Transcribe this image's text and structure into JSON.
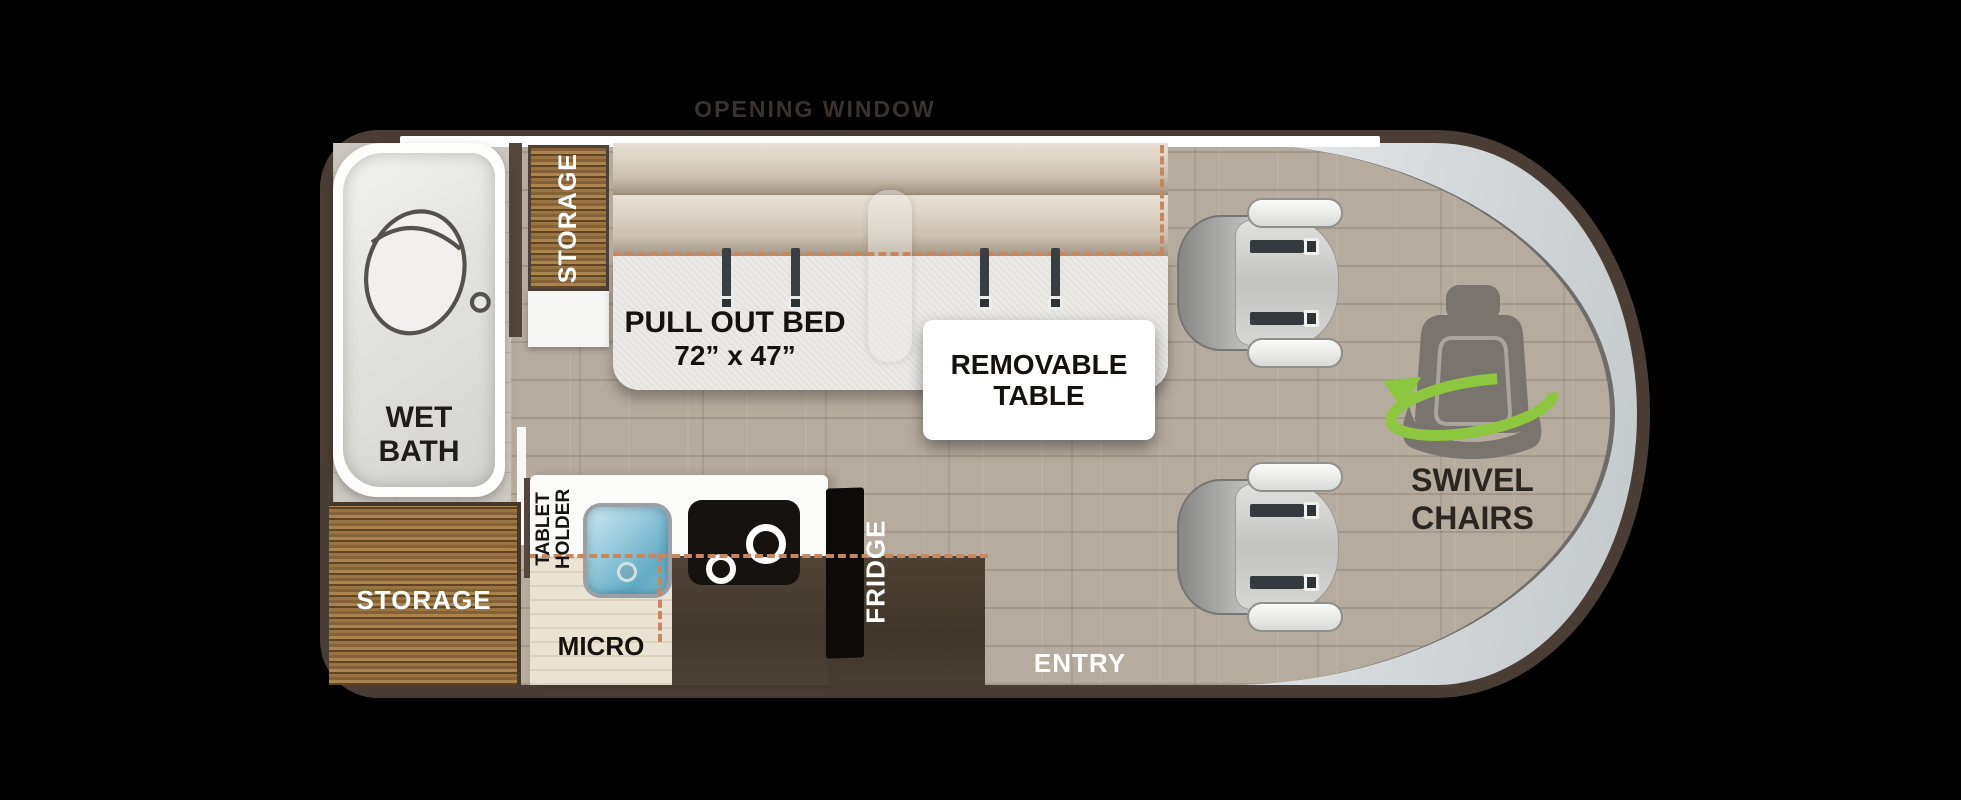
{
  "floorplan": {
    "opening_window": "OPENING WINDOW",
    "wet_bath": {
      "line1": "WET",
      "line2": "BATH"
    },
    "storage_top": {
      "label": "STORAGE"
    },
    "storage_bottom": {
      "label": "STORAGE"
    },
    "pull_out_bed": {
      "line1": "PULL OUT BED",
      "line2": "72” x 47”"
    },
    "removable_table": {
      "line1": "REMOVABLE",
      "line2": "TABLE"
    },
    "swivel_chairs": {
      "line1": "SWIVEL",
      "line2": "CHAIRS"
    },
    "tablet_holder": {
      "line1": "TABLET",
      "line2": "HOLDER"
    },
    "micro": {
      "label": "MICRO"
    },
    "fridge": {
      "label": "FRIDGE"
    },
    "entry": {
      "label": "ENTRY"
    },
    "colors": {
      "wall_brown": "#4a3d35",
      "dashed_accent": "#c4875f",
      "swivel_green": "#8dc63f",
      "belt_gray": "#343a3d",
      "sink_blue": "#63abc6"
    }
  }
}
